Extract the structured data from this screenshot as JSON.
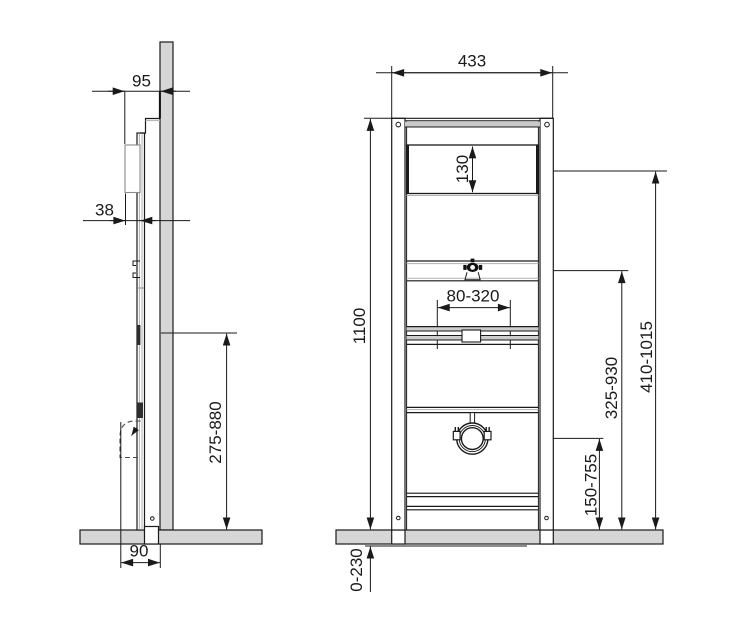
{
  "drawing": {
    "side_view": {
      "depth_to_wall": "95",
      "profile_depth": "38",
      "outlet_height_range": "275-880",
      "base_depth": "90"
    },
    "front_view": {
      "frame_width": "433",
      "opening_height": "130",
      "frame_height": "1100",
      "fixing_width_range": "80-320",
      "upper_height_range": "410-1015",
      "middle_height_range": "325-930",
      "clamp_height_range": "150-755",
      "foot_adjust_range": "0-230"
    }
  },
  "colors": {
    "line": "#1a1a1a",
    "concrete": "#d6d6d6",
    "band_gray": "#c9c9c9",
    "background": "#ffffff"
  }
}
